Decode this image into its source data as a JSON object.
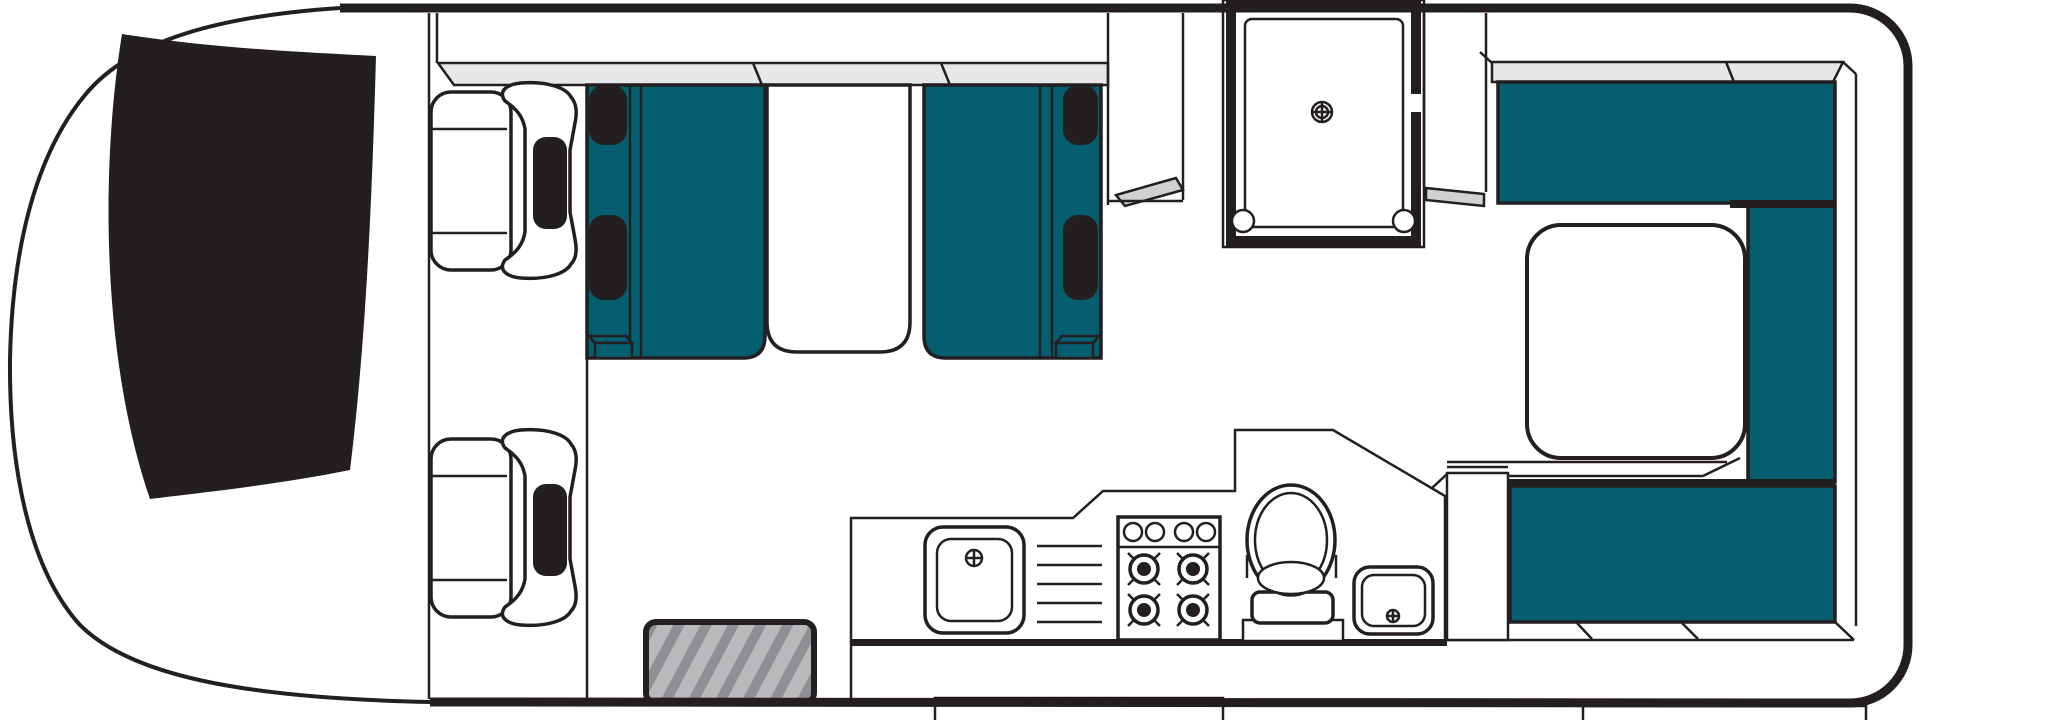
{
  "document": {
    "title": "Campervan floor plan",
    "view": "top-down layout diagram",
    "canvas": {
      "width": 2047,
      "height": 720
    }
  },
  "colors": {
    "paper": "#ffffff",
    "ink": "#231f20",
    "upholstery": "#045e70",
    "locker": "#e6e7e8",
    "shelf": "#cfd1d2",
    "mat": "#b7b9bb",
    "matStripe": "#8e9093"
  },
  "items": [
    {
      "id": "cab",
      "label": "Driver cab with windshield"
    },
    {
      "id": "driver-seat",
      "label": "Driver swivel seat"
    },
    {
      "id": "passenger-seat",
      "label": "Passenger swivel seat"
    },
    {
      "id": "dinette-front-bench",
      "label": "Dinette bench (forward)"
    },
    {
      "id": "dinette-rear-bench",
      "label": "Dinette bench (rearward)"
    },
    {
      "id": "dinette-table",
      "label": "Dinette table"
    },
    {
      "id": "overhead-locker-front",
      "label": "Overhead locker strip (front)"
    },
    {
      "id": "overhead-locker-rear",
      "label": "Overhead locker strip (rear)"
    },
    {
      "id": "entry-step",
      "label": "Entry step"
    },
    {
      "id": "entry-mat",
      "label": "Entry step mat"
    },
    {
      "id": "shower",
      "label": "Shower cubicle with drain"
    },
    {
      "id": "wardrobe",
      "label": "Wardrobe / cabinet"
    },
    {
      "id": "kitchen",
      "label": "Kitchen bench"
    },
    {
      "id": "kitchen-sink",
      "label": "Kitchen sink"
    },
    {
      "id": "drainer",
      "label": "Sink drainer"
    },
    {
      "id": "stove",
      "label": "4-burner gas stove"
    },
    {
      "id": "toilet",
      "label": "Toilet"
    },
    {
      "id": "washbasin",
      "label": "Washbasin"
    },
    {
      "id": "rear-lounge",
      "label": "Rear U-shaped lounge / bed"
    },
    {
      "id": "rear-table",
      "label": "Rear lounge table"
    },
    {
      "id": "rear-bumper",
      "label": "Rear bumper / step"
    }
  ]
}
